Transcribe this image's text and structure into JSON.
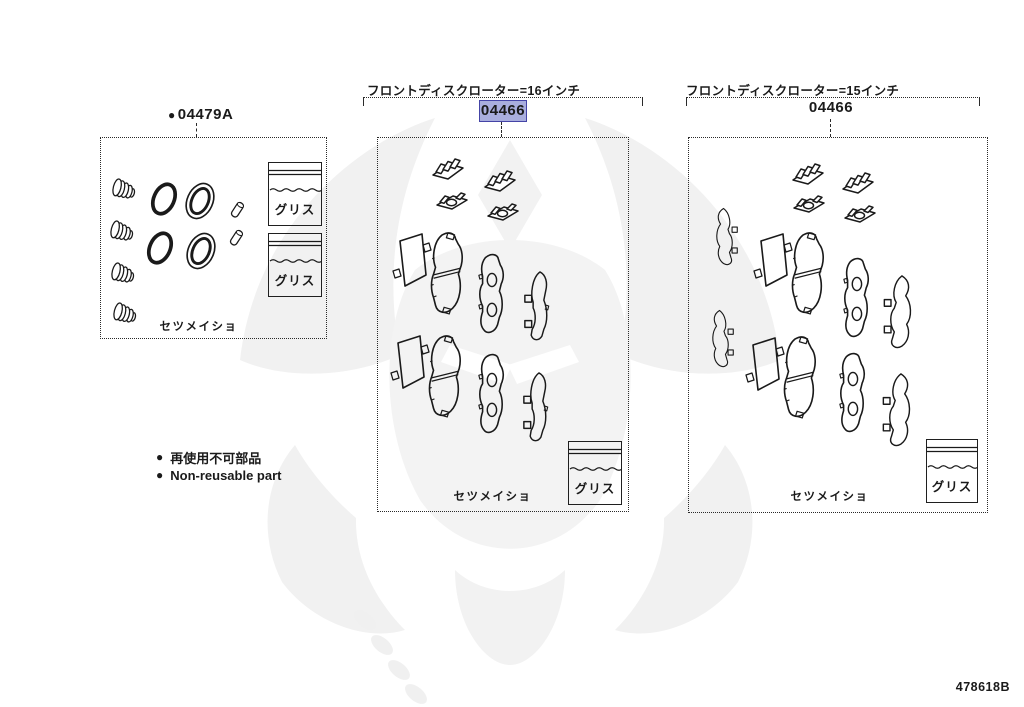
{
  "doc": {
    "code": "478618B",
    "background": "#ffffff",
    "line_color": "#1a1a1a"
  },
  "labels": {
    "grease": "グリス",
    "manual": "セツメイショ"
  },
  "legend": {
    "bullet": "●",
    "jp": "再使用不可部品",
    "en": "Non-reusable part"
  },
  "seal_kit": {
    "bullet": "●",
    "part_number": "04479A",
    "parts": [
      {
        "name": "cylinder-boot",
        "count": 4
      },
      {
        "name": "piston-seal-ring",
        "count": 2
      },
      {
        "name": "piston-dust-boot",
        "count": 2
      },
      {
        "name": "pin-cap",
        "count": 2
      },
      {
        "name": "grease-sachet",
        "count": 2
      },
      {
        "name": "instruction-sheet-note",
        "count": 1
      }
    ]
  },
  "pad_kit_16": {
    "header": "フロントディスクローター=16インチ",
    "part_number": "04466",
    "highlighted": true,
    "highlight_fill": "#a9aede",
    "highlight_border": "#4444a6",
    "parts": [
      {
        "name": "pad-fitting-clip",
        "count": 4
      },
      {
        "name": "anti-squeal-shim-plate",
        "count": 2
      },
      {
        "name": "brake-pad",
        "count": 2
      },
      {
        "name": "brake-pad-with-wear-holes",
        "count": 2
      },
      {
        "name": "side-shim",
        "count": 2
      },
      {
        "name": "grease-sachet",
        "count": 1
      },
      {
        "name": "instruction-sheet-note",
        "count": 1
      }
    ]
  },
  "pad_kit_15": {
    "header": "フロントディスクローター=15インチ",
    "part_number": "04466",
    "highlighted": false,
    "parts": [
      {
        "name": "pad-fitting-clip",
        "count": 4
      },
      {
        "name": "curved-side-shim",
        "count": 4
      },
      {
        "name": "anti-squeal-shim-plate",
        "count": 2
      },
      {
        "name": "brake-pad",
        "count": 2
      },
      {
        "name": "brake-pad-with-wear-holes",
        "count": 2
      },
      {
        "name": "grease-sachet",
        "count": 1
      },
      {
        "name": "instruction-sheet-note",
        "count": 1
      }
    ]
  }
}
